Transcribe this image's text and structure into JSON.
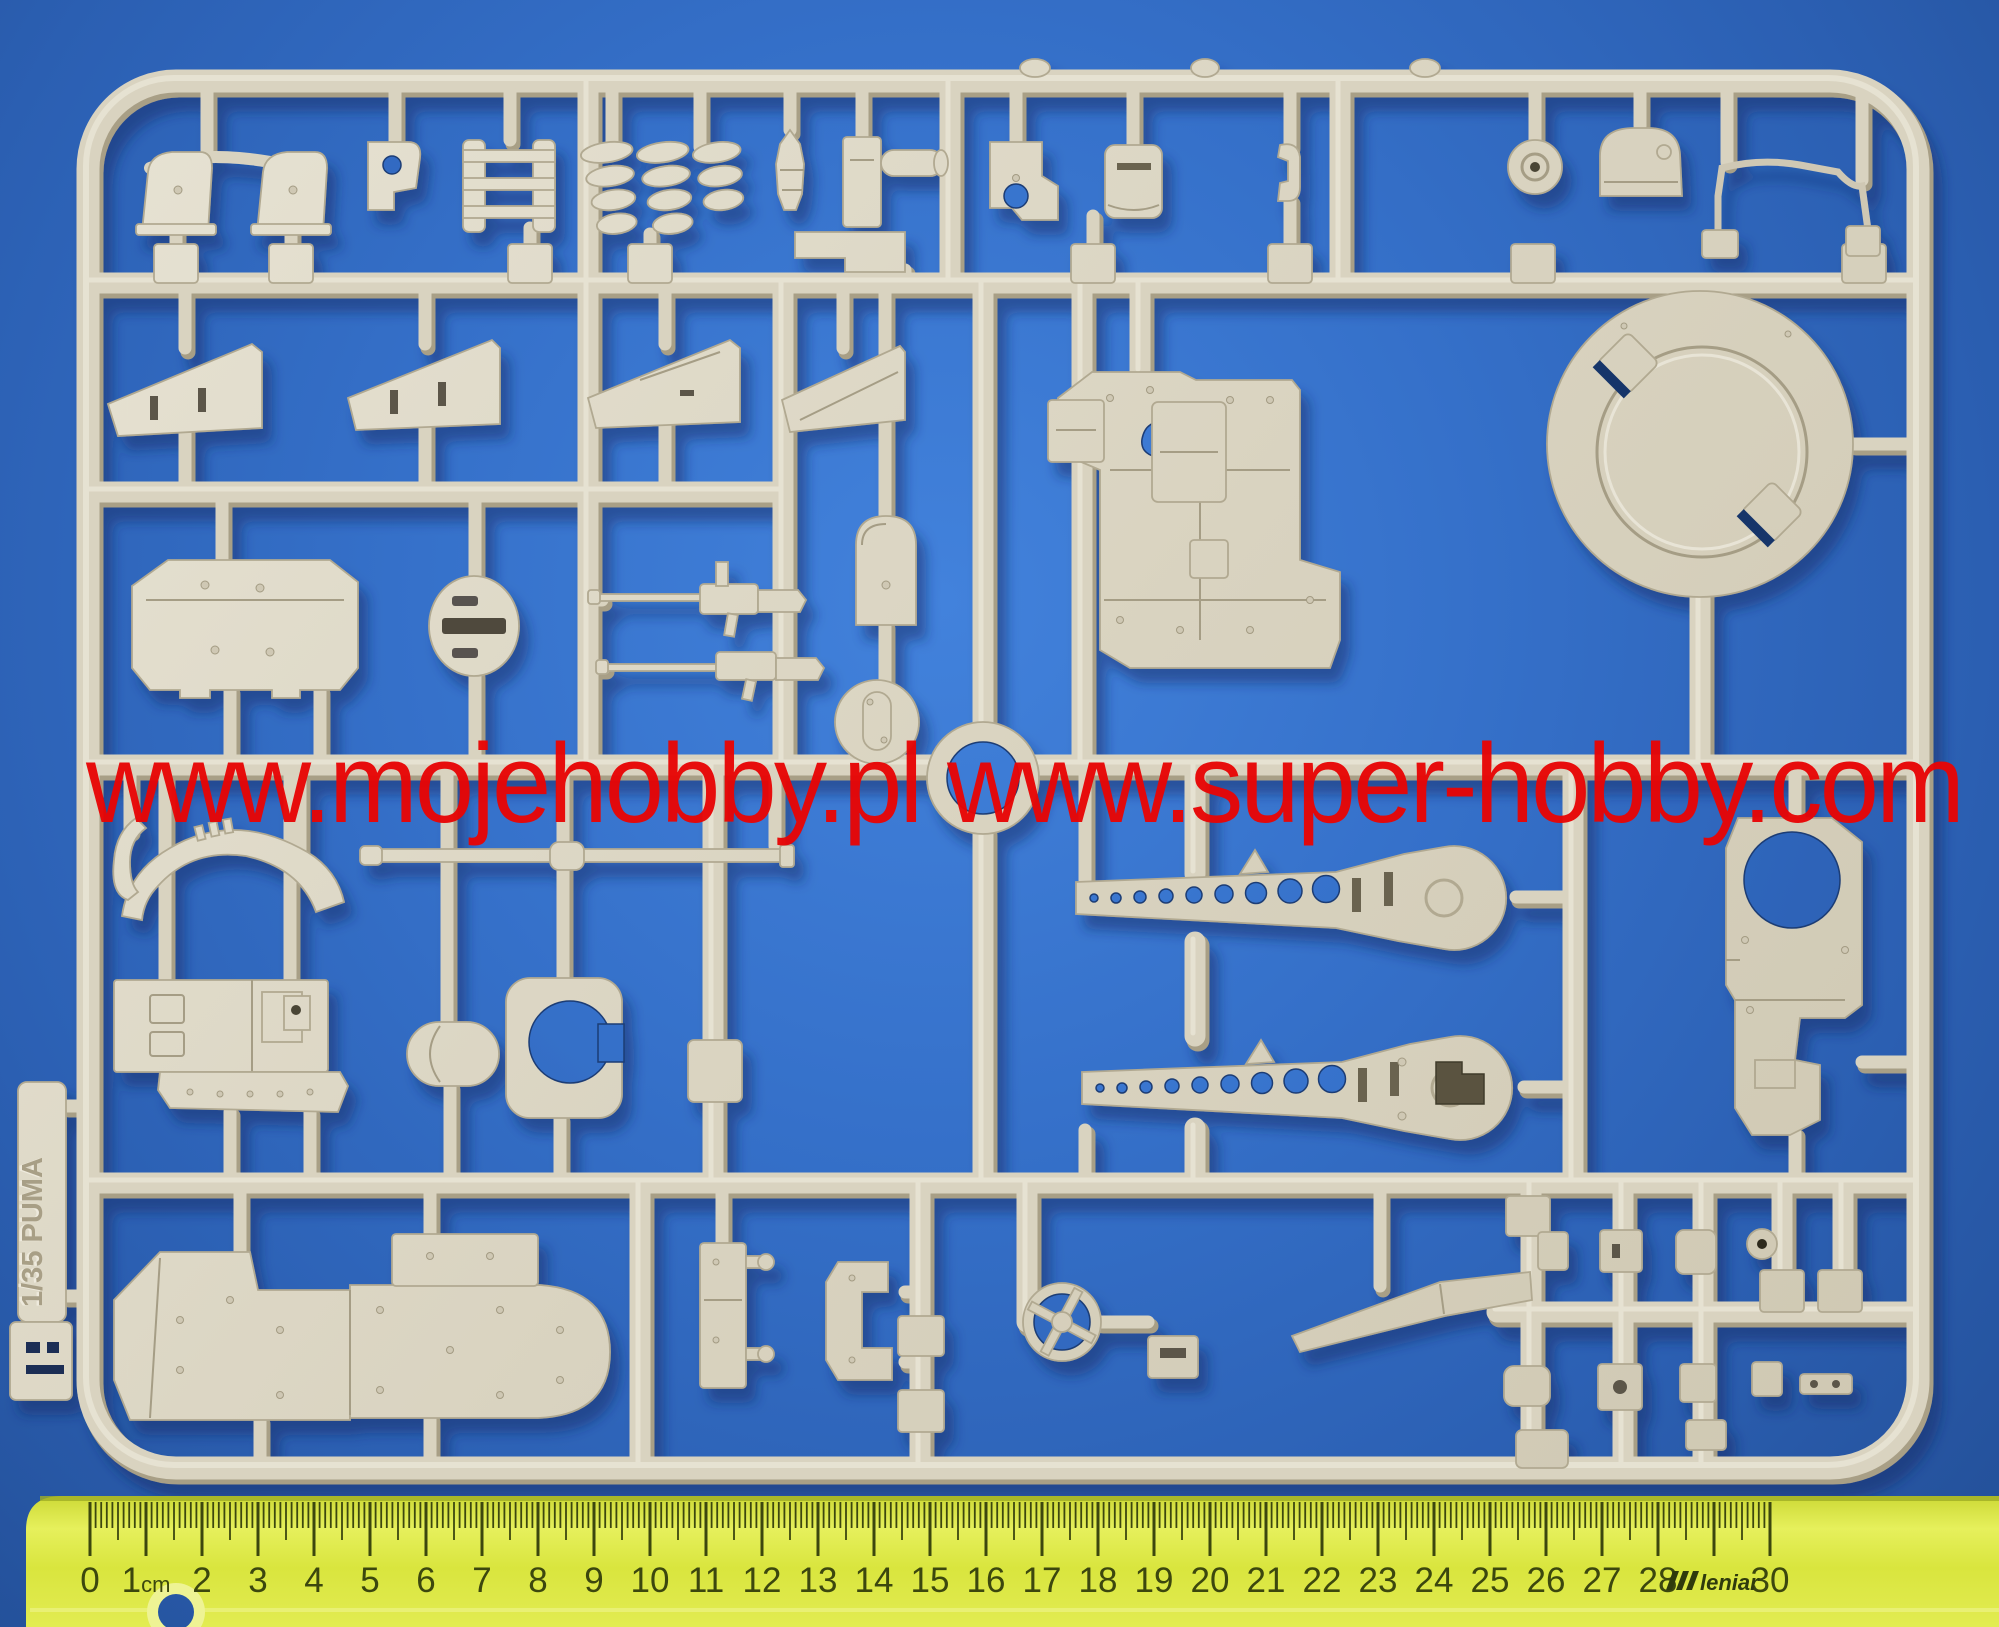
{
  "watermark": {
    "text": "www.mojehobby.pl www.super-hobby.com"
  },
  "sprue": {
    "tag_text": "1/35 PUMA",
    "letter_mark": "F"
  },
  "ruler": {
    "unit_label": "1cm",
    "tick_labels": [
      "0",
      "1cm",
      "2",
      "3",
      "4",
      "5",
      "6",
      "7",
      "8",
      "9",
      "10",
      "11",
      "12",
      "13",
      "14",
      "15",
      "16",
      "17",
      "18",
      "19",
      "20",
      "21",
      "22",
      "23",
      "24",
      "25",
      "26",
      "27",
      "28",
      "",
      "30"
    ],
    "brand": "leniar"
  },
  "colors": {
    "background": "#3570c9",
    "background_edge": "#234f97",
    "plastic": "#d9d3c0",
    "plastic_shadow": "#a89f86",
    "plastic_highlight": "#ece8db",
    "watermark_red": "#e80505",
    "ruler_yellow": "#dce63f",
    "ruler_edge": "#9fae25",
    "ruler_text": "#3c470e",
    "cast_shadow": "#0c2c66",
    "hole_dark": "#4a4436",
    "tag_mark_dark": "#1c2f55"
  }
}
